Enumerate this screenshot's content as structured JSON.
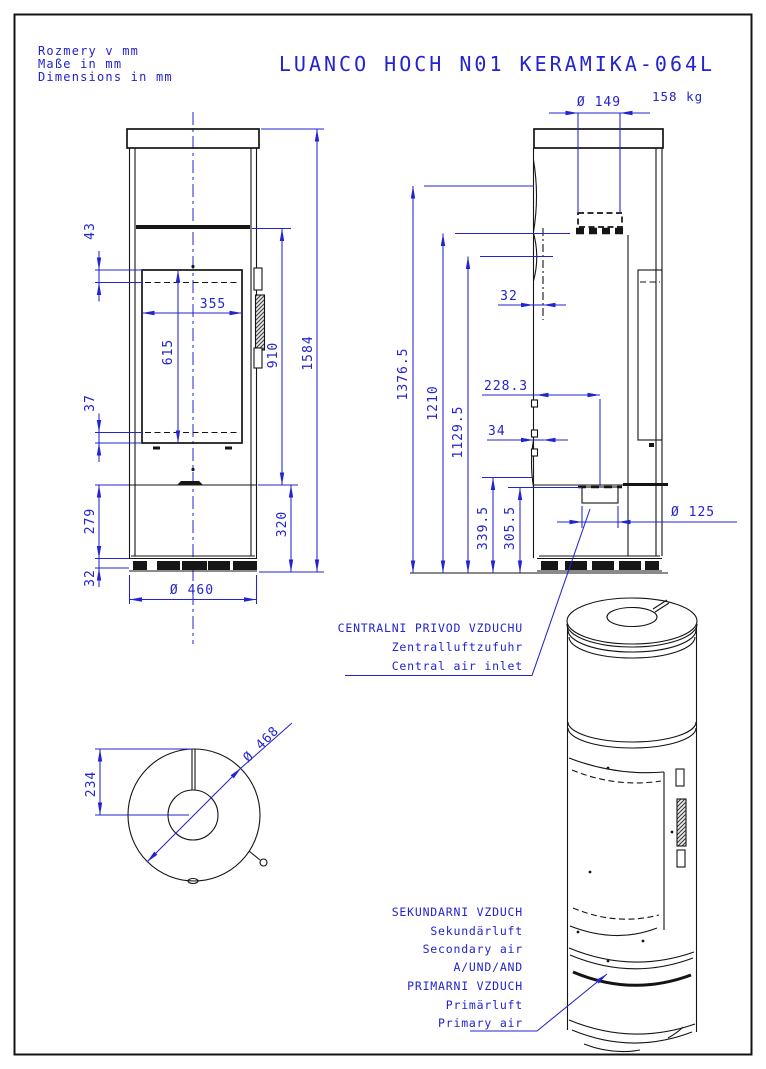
{
  "header": {
    "notes": [
      "Rozmery v mm",
      "Maße in mm",
      "Dimensions in mm"
    ],
    "title": "LUANCO HOCH N01 KERAMIKA-064L"
  },
  "front_view": {
    "dims": {
      "offset_top": "43",
      "glass_width": "355",
      "glass_height": "615",
      "offset_bottom": "37",
      "pedestal_height": "279",
      "base_height": "32",
      "module_height": "910",
      "total_height": "1584",
      "plinth_height": "320",
      "body_diameter": "Ø 460"
    }
  },
  "side_view": {
    "weight": "158 kg",
    "dims": {
      "flue_diameter": "Ø 149",
      "glass_offset": "32",
      "flue_top_height": "1376.5",
      "flue_rear_height": "1210",
      "upper_air_height": "1129.5",
      "inlet_rear_offset": "228.3",
      "lever_offset": "34",
      "lever_height": "339.5",
      "inlet_height": "305.5",
      "inlet_diameter": "Ø 125"
    }
  },
  "top_view": {
    "dims": {
      "radius": "234",
      "diameter": "Ø 468"
    }
  },
  "annotations": {
    "central_air": [
      "CENTRALNI PRIVOD VZDUCHU",
      "Zentralluftzufuhr",
      "Central air inlet"
    ],
    "secondary_primary": [
      "SEKUNDARNI VZDUCH",
      "Sekundärluft",
      "Secondary air",
      "A/UND/AND",
      "PRIMARNI VZDUCH",
      "Primärluft",
      "Primary air"
    ]
  },
  "colors": {
    "dimension_blue": "#2323cf",
    "line_black": "#141414"
  }
}
